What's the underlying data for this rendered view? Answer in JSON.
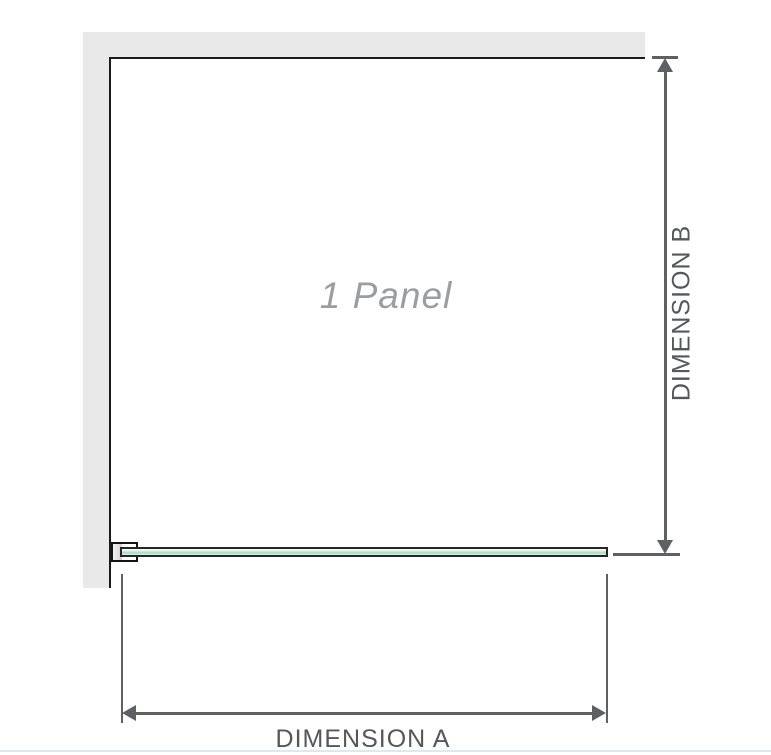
{
  "diagram": {
    "panel_label": "1 Panel",
    "dimension_a_label": "DIMENSION A",
    "dimension_b_label": "DIMENSION B",
    "colors": {
      "wall": "#e9e9e9",
      "wall_edge": "#1b1b1b",
      "bracket_outline": "#141414",
      "bracket_shim_from": "#f3f3f3",
      "bracket_shim_to": "#d2d2d2",
      "glass_outline": "#262626",
      "glass_fill_light": "#f2faf5",
      "glass_fill_mid": "#a9dcc2",
      "glass_fill_pale": "#d8f0e2",
      "dimension_line": "#5e6063",
      "dimension_text": "#55575a",
      "panel_label_color": "#9c9da1",
      "page_bottom_rule": "#e0e7ed"
    }
  }
}
